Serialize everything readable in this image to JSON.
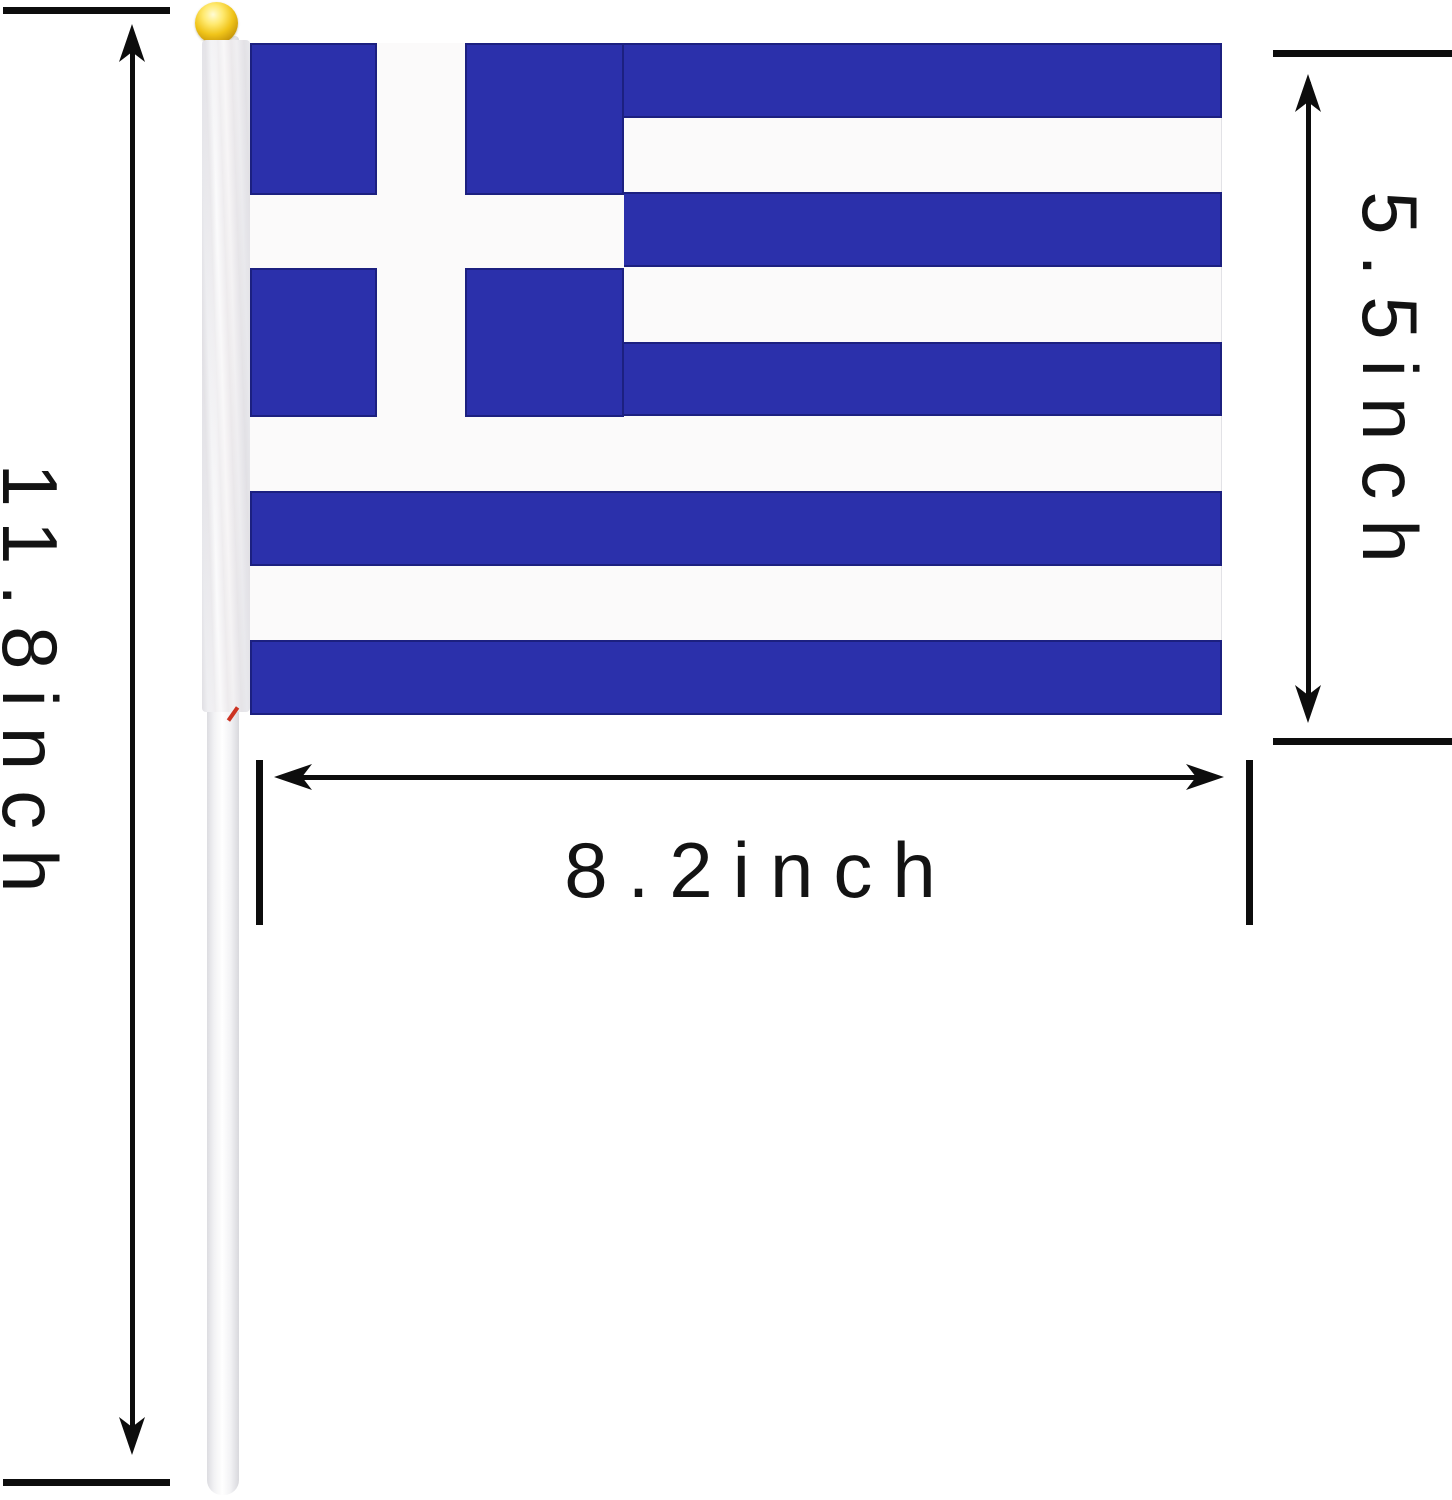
{
  "diagram": {
    "subject": "Greece hand-held stick flag with size measurements"
  },
  "flag": {
    "country": "Greece"
  },
  "dimensions": {
    "pole_height_label": "11.8inch",
    "flag_height_label": "5.5inch",
    "flag_width_label": "8.2inch"
  },
  "colors": {
    "flag_blue": "#2b30ab",
    "flag_navy": "#1c2080",
    "flag_white": "#fbfafa",
    "line_black": "#0d0d0d",
    "gold_finial": "#f0c419",
    "stitch_red": "#cc3322"
  }
}
